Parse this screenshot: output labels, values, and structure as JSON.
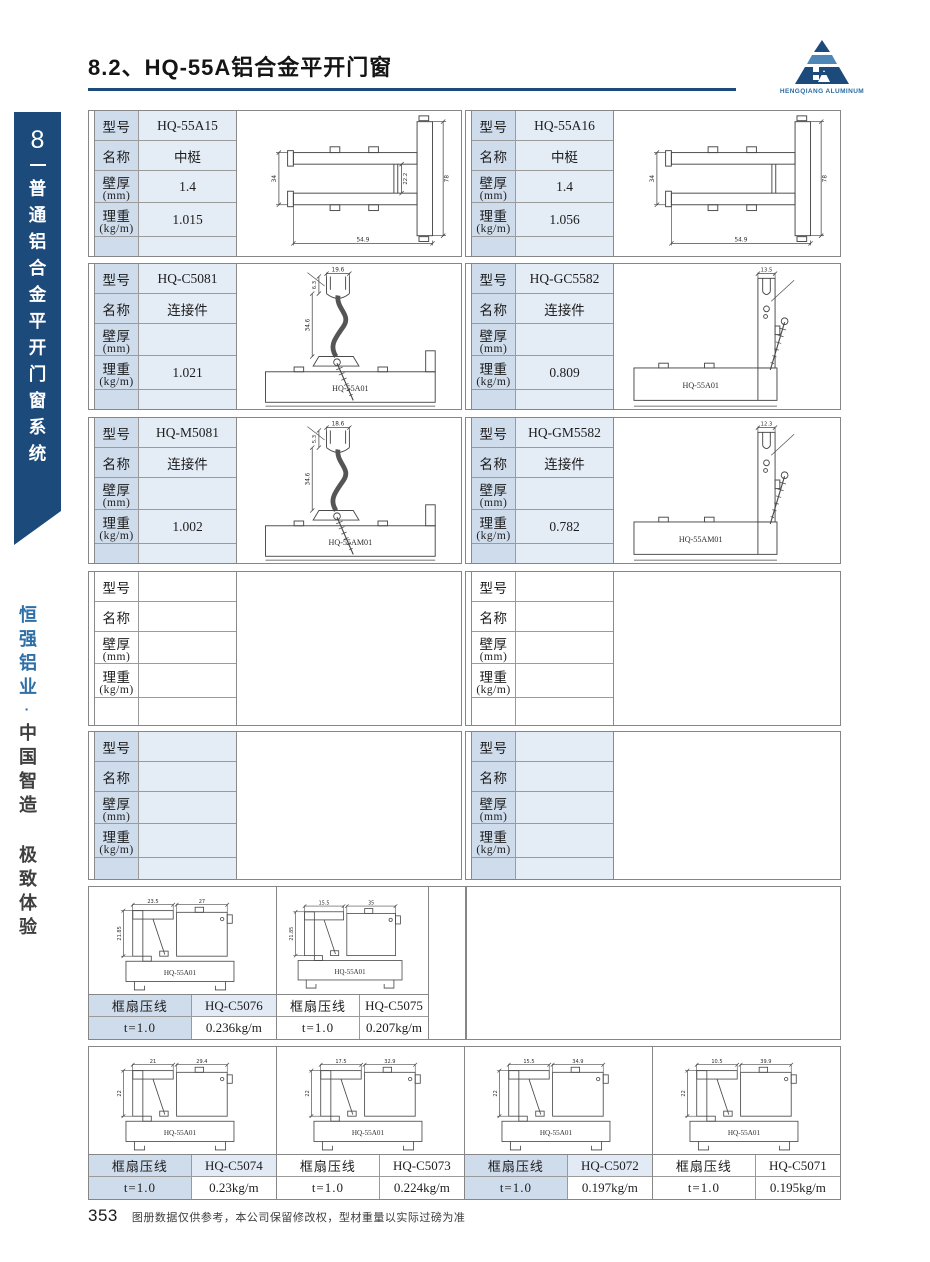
{
  "header": {
    "title": "8.2、HQ-55A铝合金平开门窗"
  },
  "logo": {
    "caption": "HENGQIANG ALUMINUM"
  },
  "sidebar": {
    "chapter_number": "8",
    "series_title": "普通铝合金平开门窗系统",
    "brand": "恒强铝业",
    "separator": "·",
    "slogan": "中国智造 极致体验"
  },
  "field_labels": {
    "model": "型号",
    "name": "名称",
    "thickness": "壁厚",
    "thickness_unit": "(mm)",
    "weight": "理重",
    "weight_unit": "(kg/m)"
  },
  "bead_labels": {
    "name": "框扇压线",
    "t": "t=1.0"
  },
  "profile_rows": [
    {
      "top": 110,
      "height": 147,
      "tinted": true,
      "cells": [
        {
          "model": "HQ-55A15",
          "name": "中梃",
          "thickness": "1.4",
          "weight": "1.015",
          "drawing": {
            "type": "mullion",
            "dims": {
              "left": "34",
              "inner": "22.2",
              "right": "78",
              "bottom": "54.9"
            }
          }
        },
        {
          "model": "HQ-55A16",
          "name": "中梃",
          "thickness": "1.4",
          "weight": "1.056",
          "drawing": {
            "type": "mullion",
            "dims": {
              "left": "34",
              "right": "78",
              "bottom": "54.9"
            }
          }
        }
      ]
    },
    {
      "top": 263,
      "height": 147,
      "tinted": true,
      "cells": [
        {
          "model": "HQ-C5081",
          "name": "连接件",
          "thickness": "",
          "weight": "1.021",
          "drawing": {
            "type": "connector-left",
            "frame_label": "HQ-55A01",
            "dims": {
              "top": "19.6",
              "upper": "6.3",
              "side": "34.6"
            }
          }
        },
        {
          "model": "HQ-GC5582",
          "name": "连接件",
          "thickness": "",
          "weight": "0.809",
          "drawing": {
            "type": "connector-right",
            "frame_label": "HQ-55A01",
            "dims": {
              "top": "13.5"
            }
          }
        }
      ]
    },
    {
      "top": 417,
      "height": 147,
      "tinted": true,
      "cells": [
        {
          "model": "HQ-M5081",
          "name": "连接件",
          "thickness": "",
          "weight": "1.002",
          "drawing": {
            "type": "connector-left",
            "frame_label": "HQ-55AM01",
            "dims": {
              "top": "18.6",
              "upper": "5.3",
              "side": "34.6"
            }
          }
        },
        {
          "model": "HQ-GM5582",
          "name": "连接件",
          "thickness": "",
          "weight": "0.782",
          "drawing": {
            "type": "connector-right",
            "frame_label": "HQ-55AM01",
            "dims": {
              "top": "12.3"
            }
          }
        }
      ]
    },
    {
      "top": 571,
      "height": 155,
      "tinted": false,
      "cells": [
        {
          "model": "",
          "name": "",
          "thickness": "",
          "weight": "",
          "drawing": null
        },
        {
          "model": "",
          "name": "",
          "thickness": "",
          "weight": "",
          "drawing": null
        }
      ]
    },
    {
      "top": 731,
      "height": 149,
      "tinted": true,
      "cells": [
        {
          "model": "",
          "name": "",
          "thickness": "",
          "weight": "",
          "drawing": null
        },
        {
          "model": "",
          "name": "",
          "thickness": "",
          "weight": "",
          "drawing": null
        }
      ]
    }
  ],
  "bead_section_top": {
    "top": 886,
    "height": 154,
    "cells": [
      {
        "code": "HQ-C5076",
        "weight": "0.236kg/m",
        "tinted": true,
        "drawing": {
          "frame_label": "HQ-55A01",
          "dims": {
            "w1": "23.5",
            "w2": "27",
            "h": "21.85"
          }
        }
      },
      {
        "code": "HQ-C5075",
        "weight": "0.207kg/m",
        "tinted": false,
        "drawing": {
          "frame_label": "HQ-55A01",
          "dims": {
            "w1": "15.5",
            "w2": "35",
            "h": "21.85"
          }
        }
      }
    ]
  },
  "bead_section_bottom": {
    "top": 1046,
    "height": 154,
    "cells": [
      {
        "code": "HQ-C5074",
        "weight": "0.23kg/m",
        "tinted": true,
        "drawing": {
          "frame_label": "HQ-55A01",
          "dims": {
            "w1": "21",
            "w2": "29.4",
            "h": "22"
          }
        }
      },
      {
        "code": "HQ-C5073",
        "weight": "0.224kg/m",
        "tinted": false,
        "drawing": {
          "frame_label": "HQ-55A01",
          "dims": {
            "w1": "17.5",
            "w2": "32.9",
            "h": "22"
          }
        }
      },
      {
        "code": "HQ-C5072",
        "weight": "0.197kg/m",
        "tinted": true,
        "drawing": {
          "frame_label": "HQ-55A01",
          "dims": {
            "w1": "15.5",
            "w2": "34.9",
            "h": "22"
          }
        }
      },
      {
        "code": "HQ-C5071",
        "weight": "0.195kg/m",
        "tinted": false,
        "drawing": {
          "frame_label": "HQ-55A01",
          "dims": {
            "w1": "10.5",
            "w2": "39.9",
            "h": "22"
          }
        }
      }
    ]
  },
  "footer": {
    "page_number": "353",
    "note": "图册数据仅供参考，本公司保留修改权，型材重量以实际过磅为准"
  },
  "colors": {
    "navy": "#1b4a7b",
    "logo_band_blue": "#4e86b6",
    "slogan_blue": "#2e6fa8",
    "tint_label_bg": "#cfdcec",
    "tint_value_bg": "#e4ecf6",
    "border_gray": "#868686"
  }
}
